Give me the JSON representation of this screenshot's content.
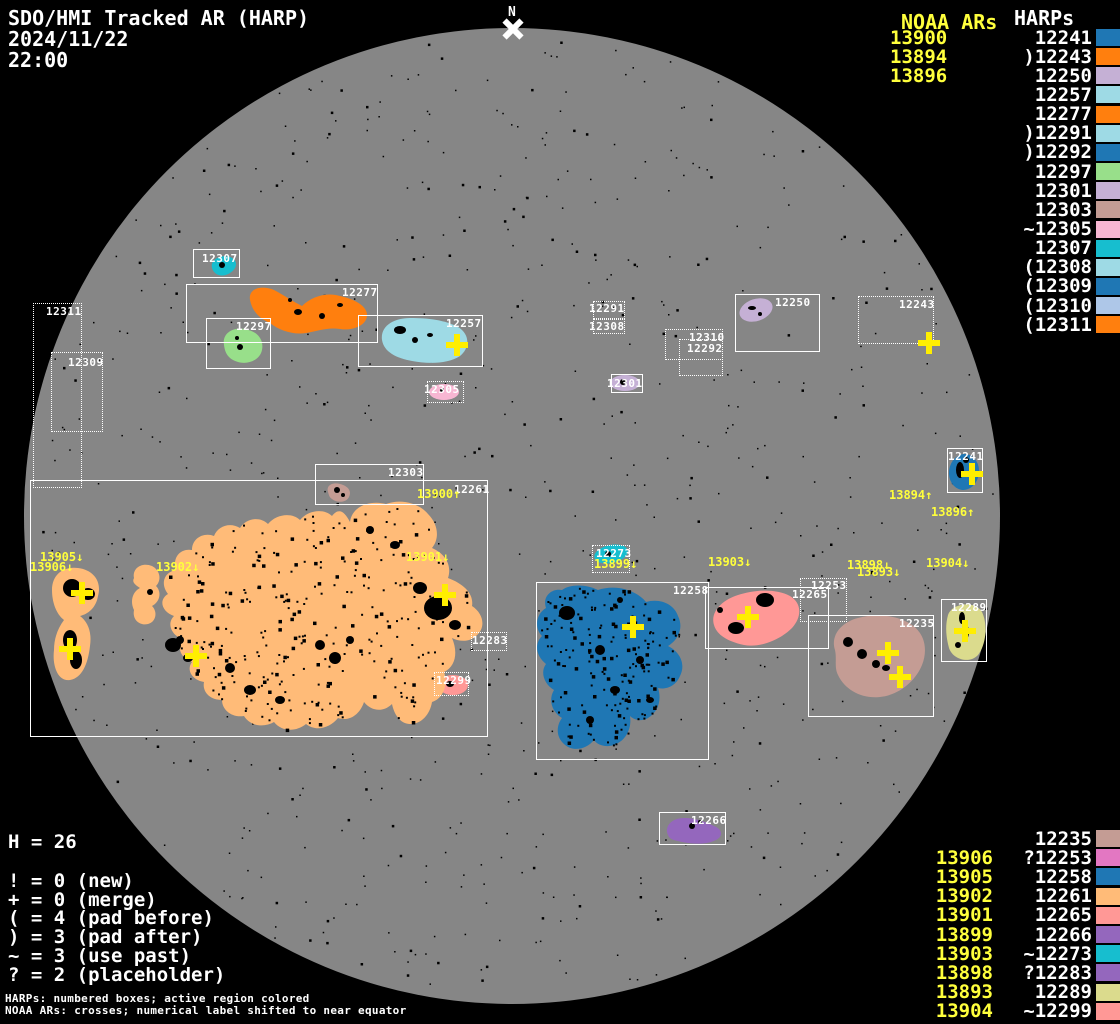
{
  "title": {
    "line1": "SDO/HMI Tracked AR (HARP)",
    "line2": "2024/11/22",
    "line3": "22:00"
  },
  "north_marker": {
    "label": "N"
  },
  "colors": {
    "background": "#000000",
    "disk": "#868686",
    "noaa_text": "#ffff3c",
    "harp_text": "#ffffff",
    "cross": "#ffee00",
    "spot": "#000000"
  },
  "palette": {
    "12235": "#c49c94",
    "12241": "#1f77b4",
    "12243": "#ff7f0e",
    "12250": "#c5b0d5",
    "12253": "#e377c2",
    "12257": "#9edae5",
    "12258": "#1f77b4",
    "12261": "#ffbb78",
    "12265": "#ff9896",
    "12266": "#9467bd",
    "12273": "#17becf",
    "12277": "#ff7f0e",
    "12283": "#9467bd",
    "12289": "#dbdb8d",
    "12291": "#9edae5",
    "12292": "#1f77b4",
    "12297": "#98df8a",
    "12299": "#ff9896",
    "12301": "#c5b0d5",
    "12303": "#c49c94",
    "12305": "#f7b6d2",
    "12307": "#17becf",
    "12308": "#9edae5",
    "12309": "#1f77b4",
    "12310": "#aec7e8",
    "12311": "#ff7f0e"
  },
  "top_right": {
    "noaa_header": "NOAA ARs",
    "harp_header": "HARPs",
    "rows": [
      {
        "noaa": "13900",
        "prefix": "",
        "harp": "12241"
      },
      {
        "noaa": "13894",
        "prefix": ")",
        "harp": "12243"
      },
      {
        "noaa": "13896",
        "prefix": "",
        "harp": "12250"
      },
      {
        "noaa": "",
        "prefix": "",
        "harp": "12257"
      },
      {
        "noaa": "",
        "prefix": "",
        "harp": "12277"
      },
      {
        "noaa": "",
        "prefix": ")",
        "harp": "12291"
      },
      {
        "noaa": "",
        "prefix": ")",
        "harp": "12292"
      },
      {
        "noaa": "",
        "prefix": "",
        "harp": "12297"
      },
      {
        "noaa": "",
        "prefix": "",
        "harp": "12301"
      },
      {
        "noaa": "",
        "prefix": "",
        "harp": "12303"
      },
      {
        "noaa": "",
        "prefix": "~",
        "harp": "12305"
      },
      {
        "noaa": "",
        "prefix": "",
        "harp": "12307"
      },
      {
        "noaa": "",
        "prefix": "(",
        "harp": "12308"
      },
      {
        "noaa": "",
        "prefix": "(",
        "harp": "12309"
      },
      {
        "noaa": "",
        "prefix": "(",
        "harp": "12310"
      },
      {
        "noaa": "",
        "prefix": "(",
        "harp": "12311"
      }
    ]
  },
  "bottom_right": {
    "rows": [
      {
        "noaa": "",
        "prefix": "",
        "harp": "12235"
      },
      {
        "noaa": "13906",
        "prefix": "?",
        "harp": "12253"
      },
      {
        "noaa": "13905",
        "prefix": "",
        "harp": "12258"
      },
      {
        "noaa": "13902",
        "prefix": "",
        "harp": "12261"
      },
      {
        "noaa": "13901",
        "prefix": "",
        "harp": "12265"
      },
      {
        "noaa": "13899",
        "prefix": "",
        "harp": "12266"
      },
      {
        "noaa": "13903",
        "prefix": "~",
        "harp": "12273"
      },
      {
        "noaa": "13898",
        "prefix": "?",
        "harp": "12283"
      },
      {
        "noaa": "13893",
        "prefix": "",
        "harp": "12289"
      },
      {
        "noaa": "13904",
        "prefix": "~",
        "harp": "12299"
      }
    ]
  },
  "legend": {
    "h_count": "H = 26",
    "items": [
      "! = 0 (new)",
      "+ = 0 (merge)",
      "( = 4 (pad before)",
      ") = 3 (pad after)",
      "~ = 3 (use past)",
      "? = 2 (placeholder)"
    ],
    "footer": [
      "HARPs: numbered boxes; active region colored",
      "NOAA ARs: crosses; numerical label shifted to near equator"
    ]
  },
  "disk": {
    "boxes": [
      {
        "id": "12307",
        "x": 193,
        "y": 249,
        "w": 47,
        "h": 29,
        "style": "solid",
        "lx": 202,
        "ly": 253
      },
      {
        "id": "12277",
        "x": 186,
        "y": 284,
        "w": 192,
        "h": 59,
        "style": "solid",
        "lx": 342,
        "ly": 287
      },
      {
        "id": "12297",
        "x": 206,
        "y": 318,
        "w": 65,
        "h": 51,
        "style": "solid",
        "lx": 236,
        "ly": 321
      },
      {
        "id": "12257",
        "x": 358,
        "y": 315,
        "w": 125,
        "h": 52,
        "style": "solid",
        "lx": 446,
        "ly": 318
      },
      {
        "id": "12311",
        "x": 33,
        "y": 303,
        "w": 49,
        "h": 185,
        "style": "dotted",
        "lx": 46,
        "ly": 306
      },
      {
        "id": "12309",
        "x": 51,
        "y": 352,
        "w": 52,
        "h": 80,
        "style": "dotted",
        "lx": 68,
        "ly": 357
      },
      {
        "id": "12291",
        "x": 593,
        "y": 301,
        "w": 32,
        "h": 18,
        "style": "dotted",
        "lx": 589,
        "ly": 303
      },
      {
        "id": "12308",
        "x": 593,
        "y": 319,
        "w": 32,
        "h": 15,
        "style": "dotted",
        "lx": 589,
        "ly": 321
      },
      {
        "id": "12310",
        "x": 665,
        "y": 329,
        "w": 58,
        "h": 31,
        "style": "dotted",
        "lx": 689,
        "ly": 332
      },
      {
        "id": "12292",
        "x": 679,
        "y": 339,
        "w": 44,
        "h": 37,
        "style": "dotted",
        "lx": 687,
        "ly": 343
      },
      {
        "id": "12250",
        "x": 735,
        "y": 294,
        "w": 85,
        "h": 58,
        "style": "solid",
        "lx": 775,
        "ly": 297
      },
      {
        "id": "12243",
        "x": 858,
        "y": 296,
        "w": 76,
        "h": 48,
        "style": "dotted",
        "lx": 899,
        "ly": 299
      },
      {
        "id": "12301",
        "x": 611,
        "y": 374,
        "w": 32,
        "h": 19,
        "style": "solid",
        "lx": 607,
        "ly": 378
      },
      {
        "id": "12305",
        "x": 427,
        "y": 381,
        "w": 37,
        "h": 22,
        "style": "dotted",
        "lx": 424,
        "ly": 384
      },
      {
        "id": "12303",
        "x": 315,
        "y": 464,
        "w": 109,
        "h": 41,
        "style": "solid",
        "lx": 388,
        "ly": 467
      },
      {
        "id": "12261",
        "x": 30,
        "y": 480,
        "w": 458,
        "h": 257,
        "style": "solid",
        "lx": 454,
        "ly": 484
      },
      {
        "id": "12273",
        "x": 592,
        "y": 545,
        "w": 38,
        "h": 28,
        "style": "dotted",
        "lx": 596,
        "ly": 548
      },
      {
        "id": "12258",
        "x": 536,
        "y": 582,
        "w": 173,
        "h": 178,
        "style": "solid",
        "lx": 673,
        "ly": 585
      },
      {
        "id": "12253",
        "x": 800,
        "y": 578,
        "w": 47,
        "h": 44,
        "style": "dotted",
        "lx": 811,
        "ly": 580
      },
      {
        "id": "12265",
        "x": 705,
        "y": 587,
        "w": 124,
        "h": 62,
        "style": "solid",
        "lx": 792,
        "ly": 589
      },
      {
        "id": "12235",
        "x": 808,
        "y": 615,
        "w": 126,
        "h": 102,
        "style": "solid",
        "lx": 899,
        "ly": 618
      },
      {
        "id": "12289",
        "x": 941,
        "y": 599,
        "w": 46,
        "h": 63,
        "style": "solid",
        "lx": 951,
        "ly": 602
      },
      {
        "id": "12283",
        "x": 471,
        "y": 632,
        "w": 36,
        "h": 19,
        "style": "dotted",
        "lx": 472,
        "ly": 635
      },
      {
        "id": "12299",
        "x": 434,
        "y": 672,
        "w": 35,
        "h": 24,
        "style": "dotted",
        "lx": 436,
        "ly": 675
      },
      {
        "id": "12241",
        "x": 947,
        "y": 448,
        "w": 36,
        "h": 45,
        "style": "solid",
        "lx": 948,
        "ly": 451
      },
      {
        "id": "12266",
        "x": 659,
        "y": 812,
        "w": 67,
        "h": 33,
        "style": "solid",
        "lx": 691,
        "ly": 815
      }
    ],
    "noaa_labels": [
      {
        "text": "13900↑",
        "x": 417,
        "y": 488
      },
      {
        "text": "13894↑",
        "x": 889,
        "y": 489
      },
      {
        "text": "13896↑",
        "x": 931,
        "y": 506
      },
      {
        "text": "13905↓",
        "x": 40,
        "y": 551
      },
      {
        "text": "13906↓",
        "x": 30,
        "y": 561
      },
      {
        "text": "13902↓",
        "x": 156,
        "y": 561
      },
      {
        "text": "13901↓",
        "x": 406,
        "y": 551
      },
      {
        "text": "13899↓",
        "x": 594,
        "y": 558
      },
      {
        "text": "13903↓",
        "x": 708,
        "y": 556
      },
      {
        "text": "13898↓",
        "x": 847,
        "y": 559
      },
      {
        "text": "13893↓",
        "x": 857,
        "y": 566
      },
      {
        "text": "13904↓",
        "x": 926,
        "y": 557
      }
    ],
    "crosses": [
      {
        "x": 457,
        "y": 345
      },
      {
        "x": 929,
        "y": 343
      },
      {
        "x": 972,
        "y": 474
      },
      {
        "x": 82,
        "y": 593
      },
      {
        "x": 70,
        "y": 649
      },
      {
        "x": 196,
        "y": 656
      },
      {
        "x": 445,
        "y": 595
      },
      {
        "x": 633,
        "y": 627
      },
      {
        "x": 748,
        "y": 617
      },
      {
        "x": 888,
        "y": 653
      },
      {
        "x": 900,
        "y": 677
      },
      {
        "x": 965,
        "y": 631
      }
    ]
  }
}
